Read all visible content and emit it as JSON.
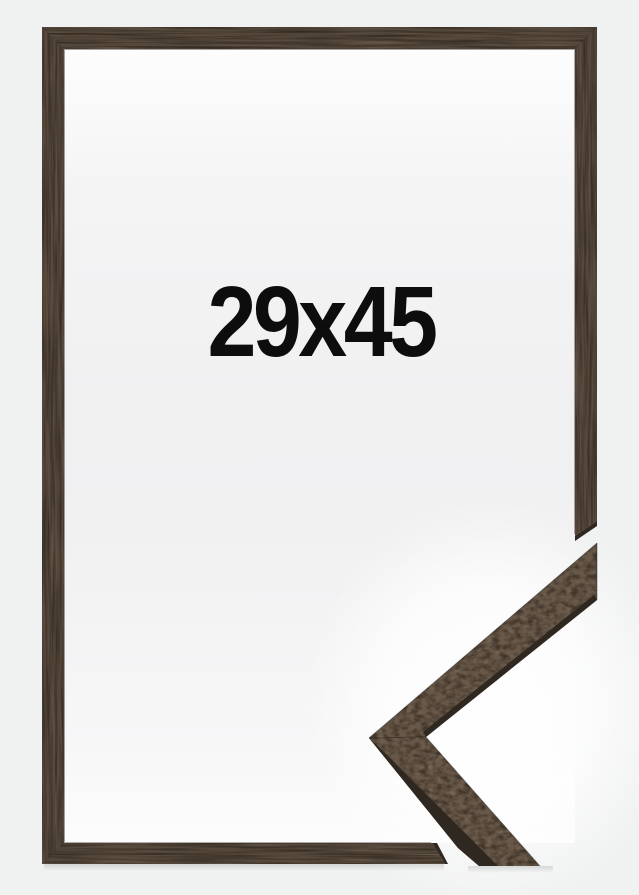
{
  "product": {
    "size_label": "29x45"
  },
  "colors": {
    "background": "#f0f1f1",
    "label_text": "#0d0d0d",
    "frame_wood": "#574a3d",
    "corner_wood": "#675849",
    "dark_edge": "#2f2820",
    "glow": "#ffffff"
  }
}
